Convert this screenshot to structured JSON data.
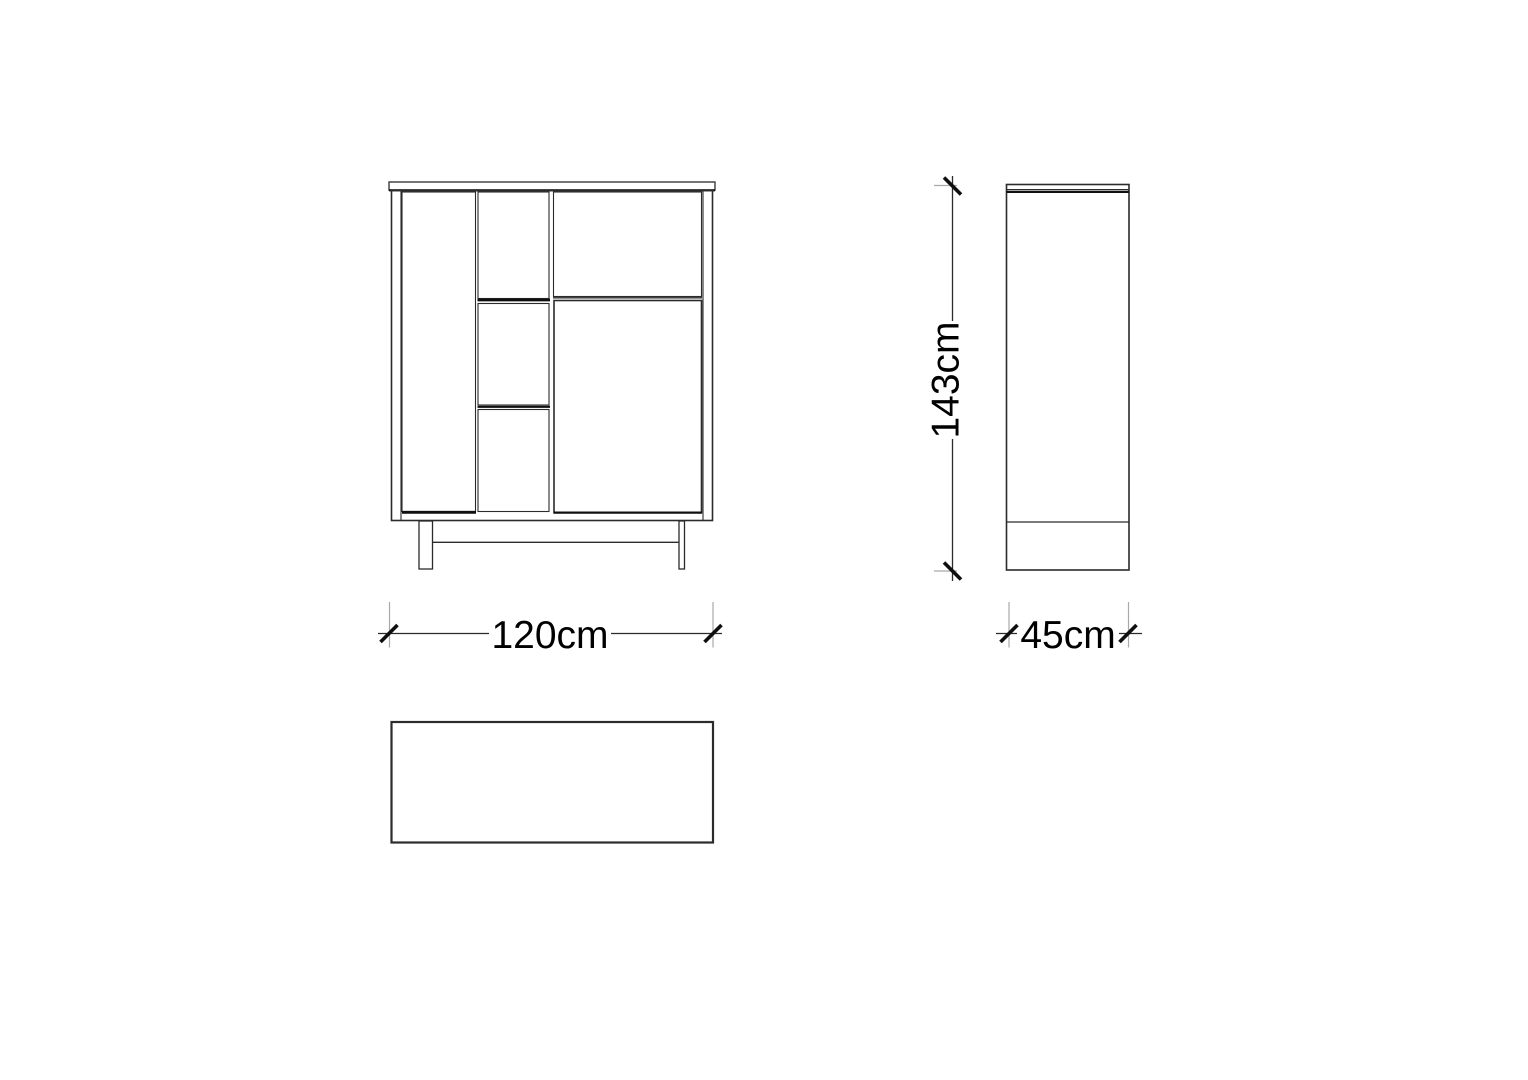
{
  "drawing": {
    "colors": {
      "bg": "#ffffff",
      "line": "#2b2b2b",
      "thick": "#0f0f0f",
      "ext": "#a9a9a9",
      "text": "#000000"
    },
    "dimensions": {
      "width": {
        "label": "120cm"
      },
      "height": {
        "label": "143cm"
      },
      "depth": {
        "label": "45cm"
      }
    }
  }
}
